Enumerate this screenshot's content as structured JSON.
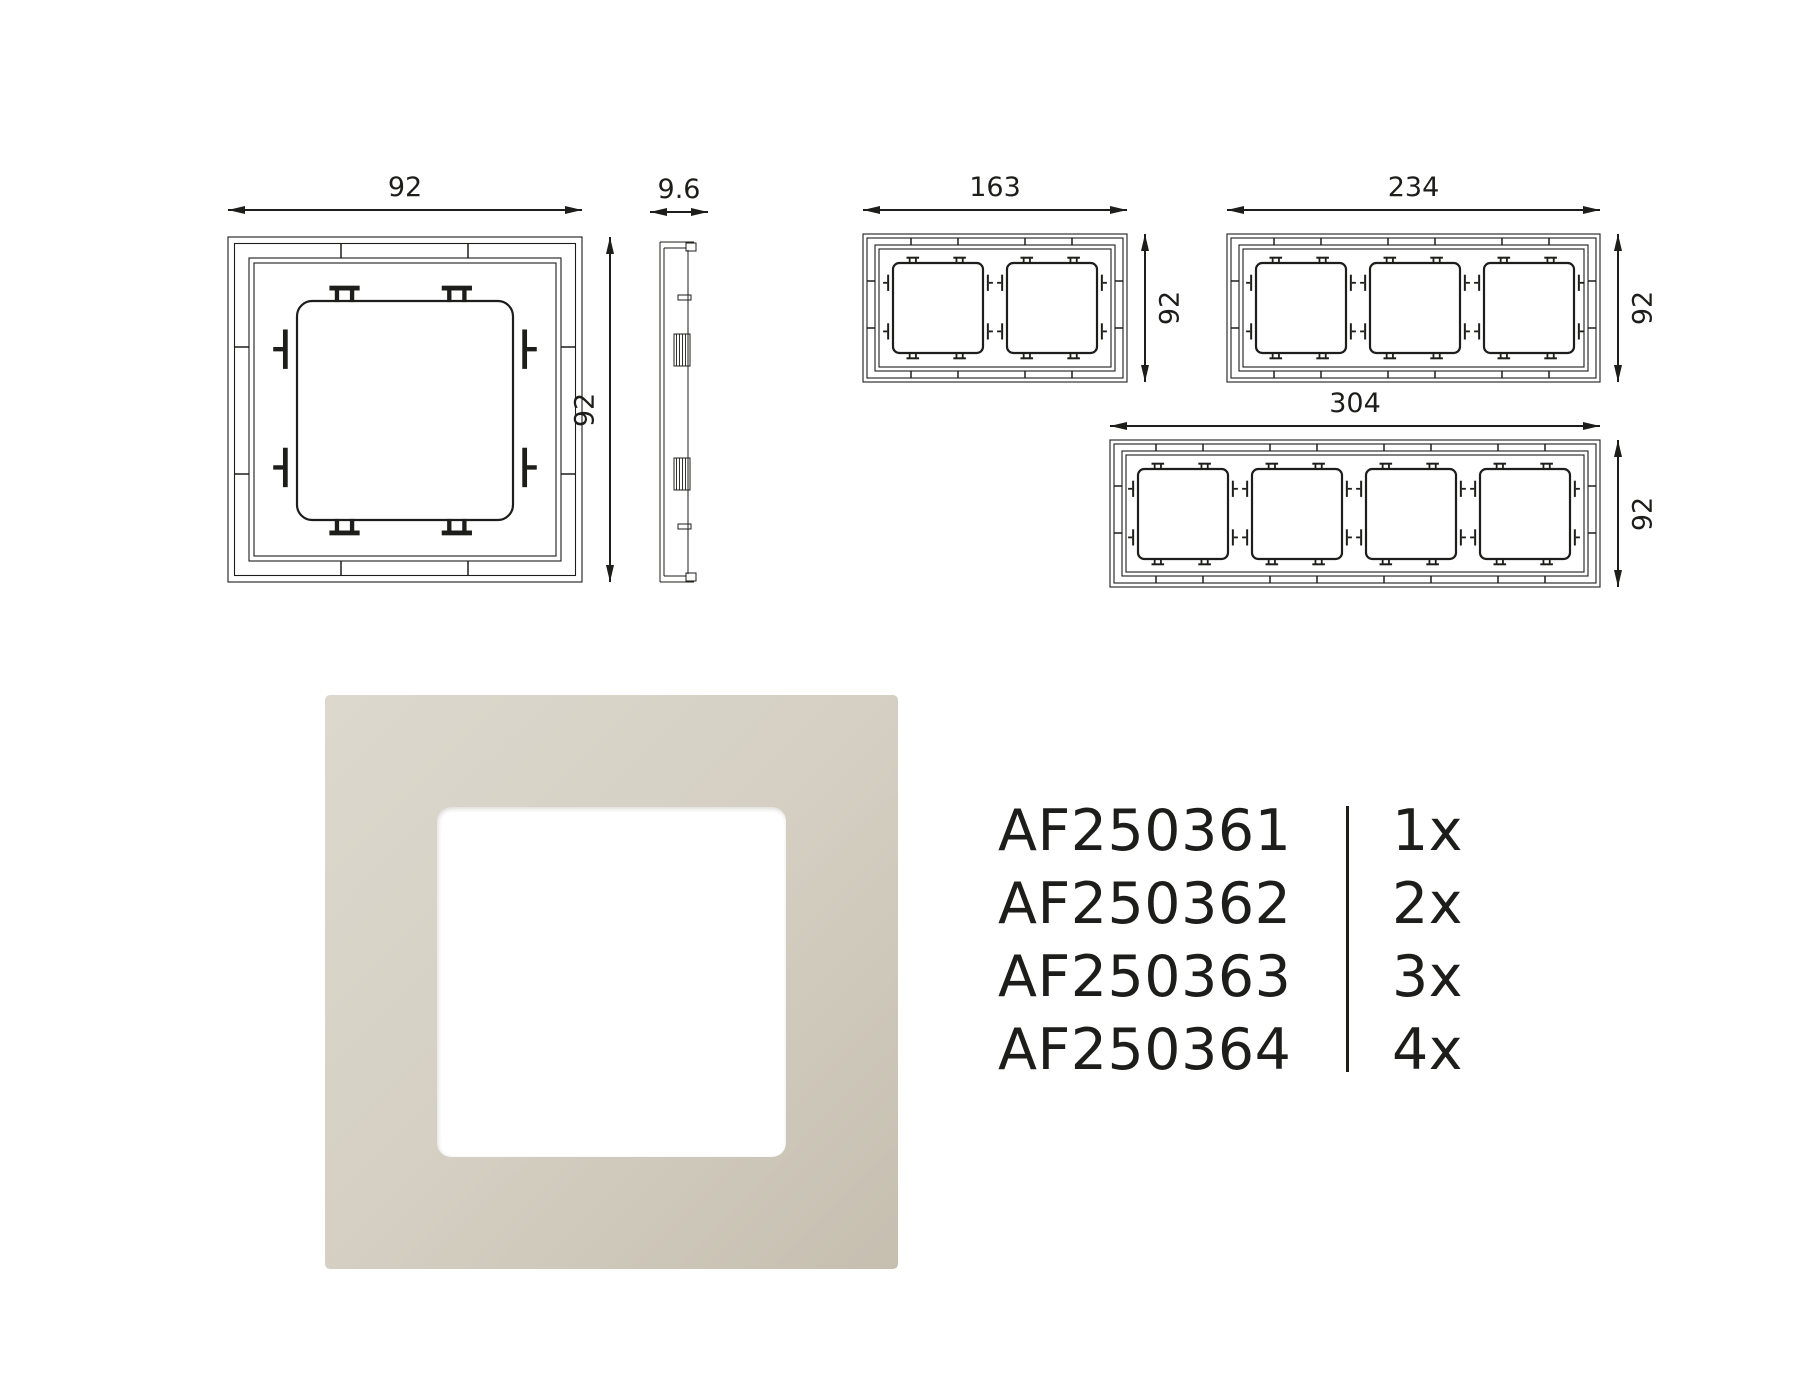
{
  "colors": {
    "ink": "#1d1d1b",
    "photo_frame_light": "#dcd8ce",
    "photo_frame_mid": "#d5d0c3",
    "photo_frame_dark": "#c6bfb0",
    "photo_window": "#ffffff"
  },
  "drawings": {
    "front_1gang": {
      "width_mm": "92",
      "height_mm": "92"
    },
    "side_view": {
      "depth_mm": "9.6"
    },
    "front_2gang": {
      "width_mm": "163",
      "height_mm": "92"
    },
    "front_3gang": {
      "width_mm": "234",
      "height_mm": "92"
    },
    "front_4gang": {
      "width_mm": "304",
      "height_mm": "92"
    }
  },
  "part_list": {
    "items": [
      {
        "sku": "AF250361",
        "qty": "1x"
      },
      {
        "sku": "AF250362",
        "qty": "2x"
      },
      {
        "sku": "AF250363",
        "qty": "3x"
      },
      {
        "sku": "AF250364",
        "qty": "4x"
      }
    ]
  }
}
